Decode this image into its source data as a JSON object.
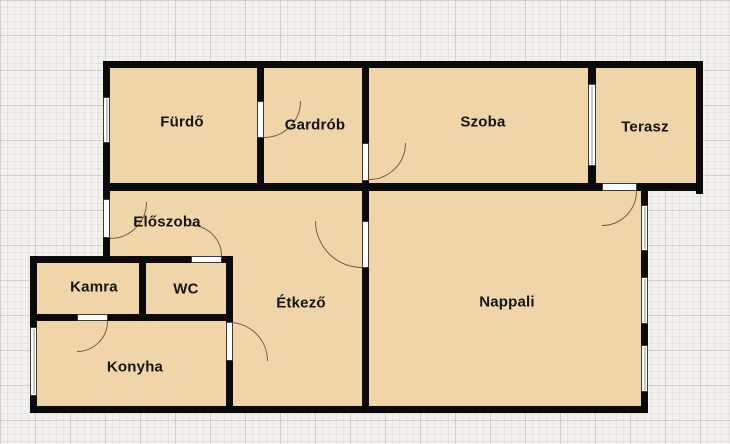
{
  "plan_title": "Apartment floor plan",
  "colors": {
    "room_fill": "#f0d5a8",
    "wall": "#0a0a0a",
    "opening": "#ffffff",
    "arc": "#6d5f4b",
    "grid_bg": "#f2f1ee"
  },
  "rooms": [
    {
      "id": "furdo",
      "label": "Fürdő"
    },
    {
      "id": "gardrob",
      "label": "Gardrób"
    },
    {
      "id": "szoba",
      "label": "Szoba"
    },
    {
      "id": "terasz",
      "label": "Terasz"
    },
    {
      "id": "eloszoba",
      "label": "Előszoba"
    },
    {
      "id": "kamra",
      "label": "Kamra"
    },
    {
      "id": "wc",
      "label": "WC"
    },
    {
      "id": "etkezo",
      "label": "Étkező"
    },
    {
      "id": "nappali",
      "label": "Nappali"
    },
    {
      "id": "konyha",
      "label": "Konyha"
    }
  ]
}
